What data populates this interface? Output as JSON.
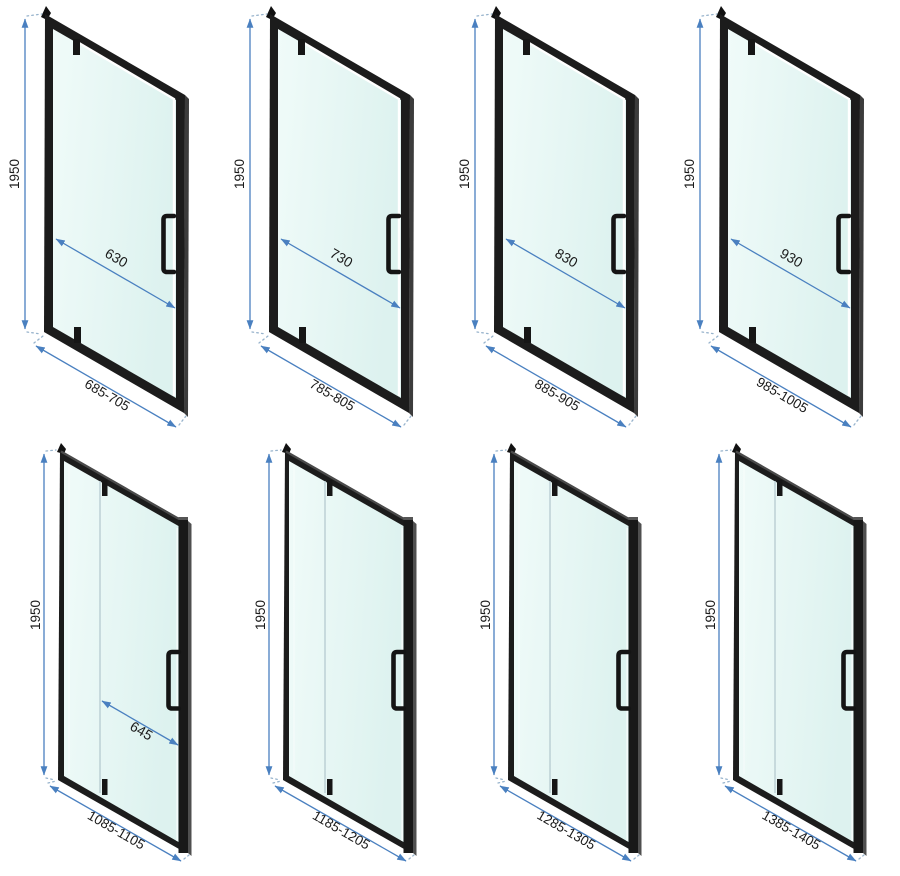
{
  "diagram": {
    "description": "Eight isometric shower-door technical drawings with dimensions in millimetres",
    "colors": {
      "background": "#ffffff",
      "frame": "#1c1c1c",
      "frame_highlight": "#4a4a4a",
      "glass": "#ddf2ef",
      "glass_light": "#f0fbf9",
      "dimension_line": "#4a80c0",
      "extension_dots": "#97b3cc",
      "label_text": "#1a1a1a",
      "divider_line": "#b9cdd3"
    },
    "rows": [
      {
        "style": "pivot-door-full-frame",
        "doors": [
          {
            "height": "1950",
            "door_width": "630",
            "width_range": "685-705"
          },
          {
            "height": "1950",
            "door_width": "730",
            "width_range": "785-805"
          },
          {
            "height": "1950",
            "door_width": "830",
            "width_range": "885-905"
          },
          {
            "height": "1950",
            "door_width": "930",
            "width_range": "985-1005"
          }
        ]
      },
      {
        "style": "pivot-door-with-fixed-panel",
        "doors": [
          {
            "height": "1950",
            "door_width": "645",
            "width_range": "1085-1105"
          },
          {
            "height": "1950",
            "width_range": "1185-1205"
          },
          {
            "height": "1950",
            "width_range": "1285-1305"
          },
          {
            "height": "1950",
            "width_range": "1385-1405"
          }
        ]
      }
    ]
  }
}
